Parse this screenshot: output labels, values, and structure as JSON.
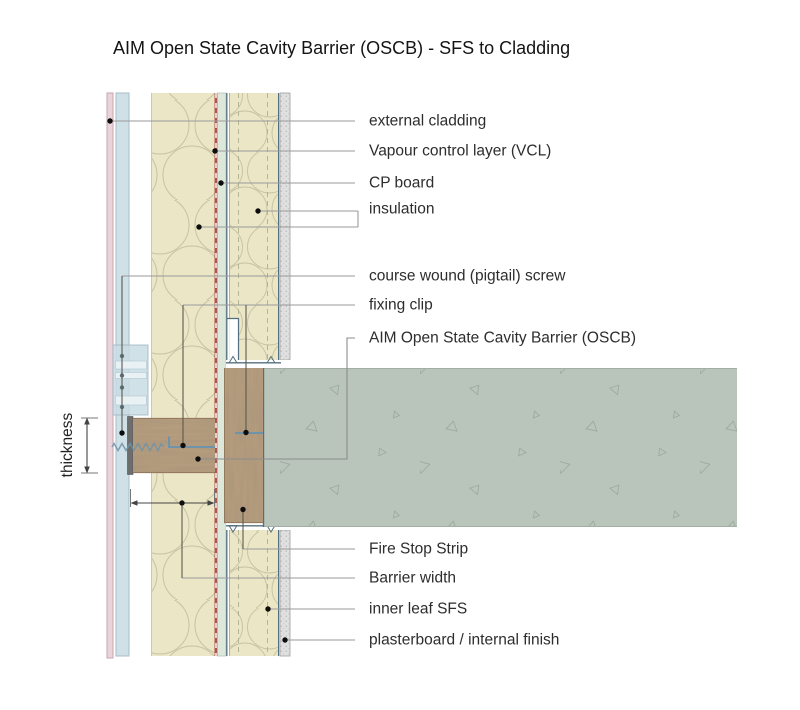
{
  "title": "AIM Open State Cavity Barrier (OSCB) - SFS to Cladding",
  "labels": {
    "external_cladding": "external cladding",
    "vcl": "Vapour control layer (VCL)",
    "cp_board": "CP board",
    "insulation": "insulation",
    "pigtail_screw": "course wound (pigtail) screw",
    "fixing_clip": "fixing clip",
    "oscb": "AIM Open State Cavity Barrier (OSCB)",
    "fire_stop_strip": "Fire Stop Strip",
    "barrier_width": "Barrier width",
    "inner_leaf_sfs": "inner leaf SFS",
    "plasterboard": "plasterboard / internal finish"
  },
  "dimensions": {
    "thickness": "thickness"
  },
  "colors": {
    "cladding_pink": "#e9d4da",
    "rail_blue": "#d0e0e7",
    "insulation_beige": "#ebe6c6",
    "vcl_red": "#b0544e",
    "cp_board_green": "#dde8db",
    "steel_blue": "#54707e",
    "clip_blue": "#6f93a8",
    "plasterboard_grey": "#e0e0e0",
    "slab_green": "#b9c4ba",
    "barrier_brown": "#b79d7e",
    "barrier_face_grey": "#6d6d6d",
    "leader_grey": "#9a9a9a"
  }
}
